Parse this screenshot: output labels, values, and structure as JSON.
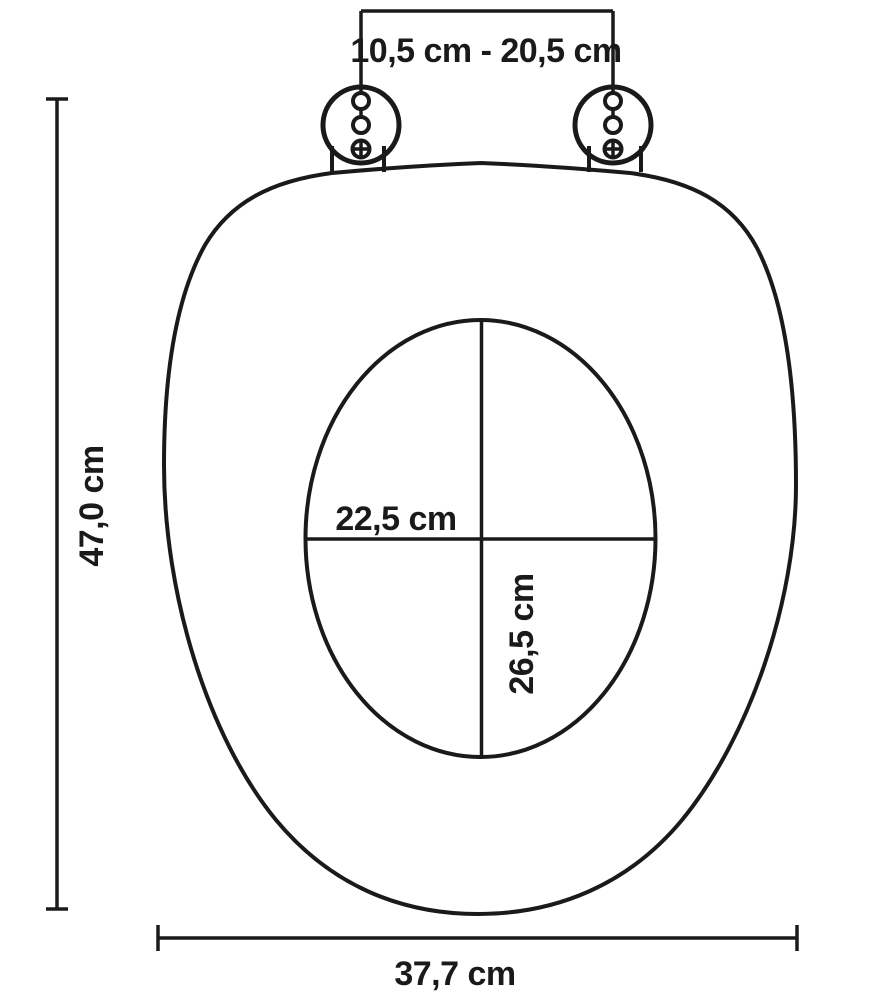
{
  "diagram": {
    "subject": "toilet-seat-dimension-diagram",
    "view": "top view line drawing",
    "background_color": "#ffffff",
    "line_color": "#1a1a1a",
    "unit": "cm",
    "labels": {
      "hinge_spacing": "10,5 cm - 20,5 cm",
      "overall_length": "47,0 cm",
      "opening_width": "22,5 cm",
      "opening_depth": "26,5 cm",
      "overall_width": "37,7 cm"
    }
  }
}
